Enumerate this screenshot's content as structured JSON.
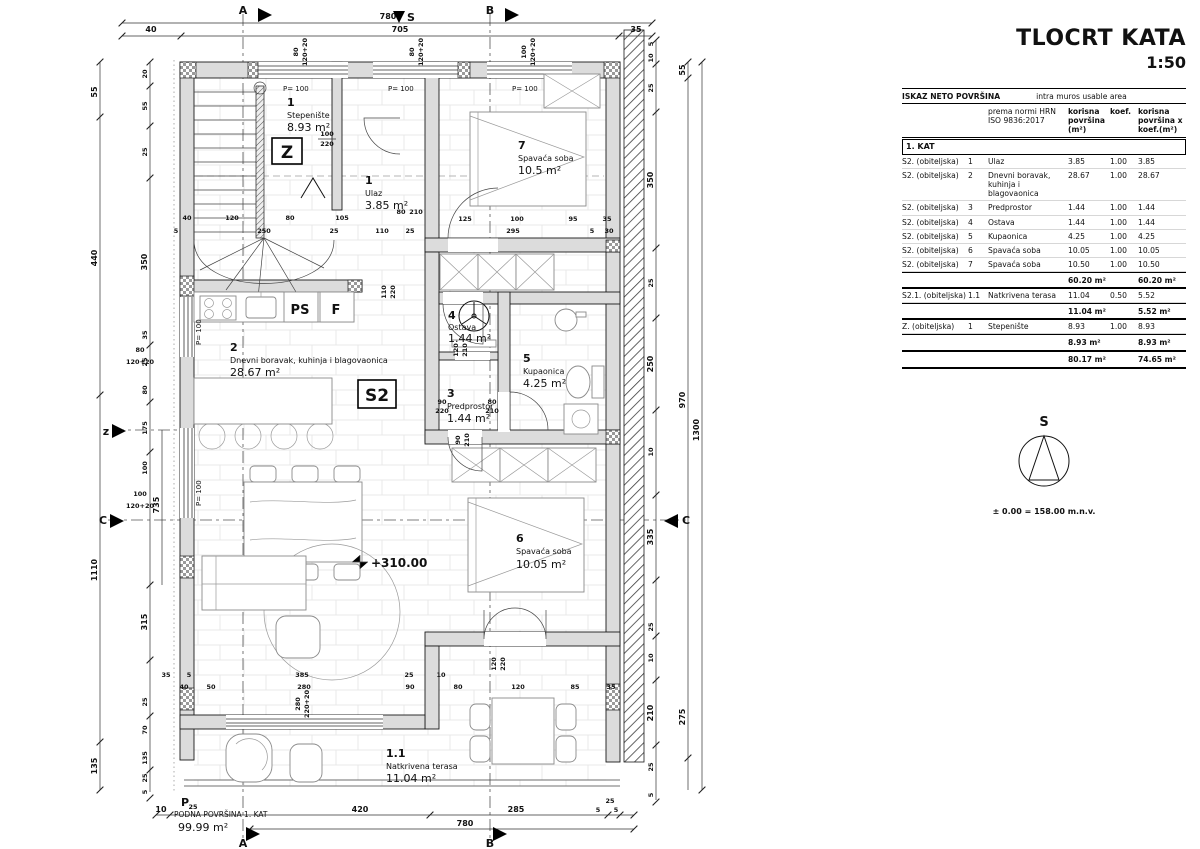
{
  "title": {
    "main": "TLOCRT KATA",
    "scale": "1:50"
  },
  "table": {
    "title_left": "ISKAZ NETO POVRŠINA",
    "title_right": "intra muros usable area",
    "col_norm": "prema normi HRN ISO 9836:2017",
    "col_area": "korisna površina (m²)",
    "col_koef": "koef.",
    "col_result": "korisna površina x koef.(m²)",
    "section": "1. KAT",
    "rows": [
      {
        "unit": "S2. (obiteljska)",
        "num": "1",
        "name": "Ulaz",
        "area": "3.85",
        "koef": "1.00",
        "result": "3.85"
      },
      {
        "unit": "S2. (obiteljska)",
        "num": "2",
        "name": "Dnevni boravak, kuhinja i blagovaonica",
        "area": "28.67",
        "koef": "1.00",
        "result": "28.67"
      },
      {
        "unit": "S2. (obiteljska)",
        "num": "3",
        "name": "Predprostor",
        "area": "1.44",
        "koef": "1.00",
        "result": "1.44"
      },
      {
        "unit": "S2. (obiteljska)",
        "num": "4",
        "name": "Ostava",
        "area": "1.44",
        "koef": "1.00",
        "result": "1.44"
      },
      {
        "unit": "S2. (obiteljska)",
        "num": "5",
        "name": "Kupaonica",
        "area": "4.25",
        "koef": "1.00",
        "result": "4.25"
      },
      {
        "unit": "S2. (obiteljska)",
        "num": "6",
        "name": "Spavaća soba",
        "area": "10.05",
        "koef": "1.00",
        "result": "10.05"
      },
      {
        "unit": "S2. (obiteljska)",
        "num": "7",
        "name": "Spavaća soba",
        "area": "10.50",
        "koef": "1.00",
        "result": "10.50"
      }
    ],
    "sub1_area": "60.20 m²",
    "sub1_result": "60.20 m²",
    "row_terrace": {
      "unit": "S2.1. (obiteljska)",
      "num": "1.1",
      "name": "Natkrivena terasa",
      "area": "11.04",
      "koef": "0.50",
      "result": "5.52"
    },
    "sub2_area": "11.04 m²",
    "sub2_result": "5.52 m²",
    "row_stairs": {
      "unit": "Z. (obiteljska)",
      "num": "1",
      "name": "Stepenište",
      "area": "8.93",
      "koef": "1.00",
      "result": "8.93"
    },
    "sub3_area": "8.93 m²",
    "sub3_result": "8.93 m²",
    "total_area": "80.17 m²",
    "total_result": "74.65 m²"
  },
  "north": {
    "label": "S",
    "level": "± 0.00 = 158.00 m.n.v."
  },
  "plan": {
    "rooms": [
      {
        "num": "1",
        "name": "Stepenište",
        "area": "8.93 m²"
      },
      {
        "num": "1",
        "name": "Ulaz",
        "area": "3.85 m²"
      },
      {
        "num": "2",
        "name": "Dnevni boravak, kuhinja i blagovaonica",
        "area": "28.67 m²"
      },
      {
        "num": "3",
        "name": "Predprostor",
        "area": "1.44 m²"
      },
      {
        "num": "4",
        "name": "Ostava",
        "area": "1.44 m²"
      },
      {
        "num": "5",
        "name": "Kupaonica",
        "area": "4.25 m²"
      },
      {
        "num": "6",
        "name": "Spavaća soba",
        "area": "10.05 m²"
      },
      {
        "num": "7",
        "name": "Spavaća soba",
        "area": "10.5 m²"
      },
      {
        "num": "1.1",
        "name": "Natkrivena terasa",
        "area": "11.04 m²"
      }
    ],
    "labels": {
      "z_box": "Z",
      "s2_box": "S2",
      "level": "+310.00",
      "parapet": "P= 100",
      "ps": "PS",
      "f": "F",
      "floor_title": "PODNA POVRŠINA 1. KAT",
      "floor_value": "99.99 m²",
      "p": "P",
      "p_sub": "25"
    },
    "markers": {
      "a": "A",
      "b": "B",
      "c": "C",
      "z": "z",
      "s": "S"
    },
    "dims": {
      "top_total": "780",
      "top": [
        "40",
        "705",
        "35"
      ],
      "bottom": [
        "10",
        "420",
        "285",
        "5",
        "5"
      ],
      "bottom_25": "25",
      "bottom_total": "780",
      "left_outer": [
        "55",
        "440",
        "1110",
        "135"
      ],
      "left_inner": [
        "20",
        "55",
        "25",
        "350",
        "35",
        "25",
        "80",
        "175",
        "100",
        "735",
        "315",
        "25",
        "70",
        "135",
        "25",
        "5"
      ],
      "right_inner": [
        "5",
        "10",
        "25",
        "350",
        "25",
        "250",
        "10",
        "335",
        "25",
        "10",
        "210",
        "25",
        "5"
      ],
      "right_outer": [
        "55",
        "970",
        "275",
        "1300"
      ],
      "stair_row1": [
        "40",
        "120",
        "80",
        "105"
      ],
      "stair_row2": [
        "5",
        "250",
        "25",
        "110",
        "25"
      ],
      "room7_row1": [
        "125",
        "100",
        "95",
        "35"
      ],
      "room7_row2": [
        "295",
        "5",
        "30"
      ],
      "low_row1": [
        "35",
        "5",
        "385",
        "25",
        "10"
      ],
      "low_row2": [
        "40",
        "50",
        "280",
        "90",
        "80",
        "120",
        "85",
        "35"
      ],
      "win_top": [
        "80",
        "120+20",
        "80",
        "120+20",
        "100",
        "120+20"
      ],
      "win_left": [
        "80",
        "120+20",
        "100",
        "120+20"
      ]
    },
    "doors": {
      "entry": [
        "100",
        "220"
      ],
      "hall": [
        "110",
        "220"
      ],
      "room7": [
        "80",
        "210"
      ],
      "ostava": [
        "120",
        "210"
      ],
      "pred_a": [
        "90",
        "220"
      ],
      "pred_b": [
        "80",
        "210"
      ],
      "bath": [
        "90",
        "210"
      ],
      "room6": [
        "120",
        "220"
      ],
      "living_win": [
        "280",
        "220+20"
      ]
    }
  }
}
